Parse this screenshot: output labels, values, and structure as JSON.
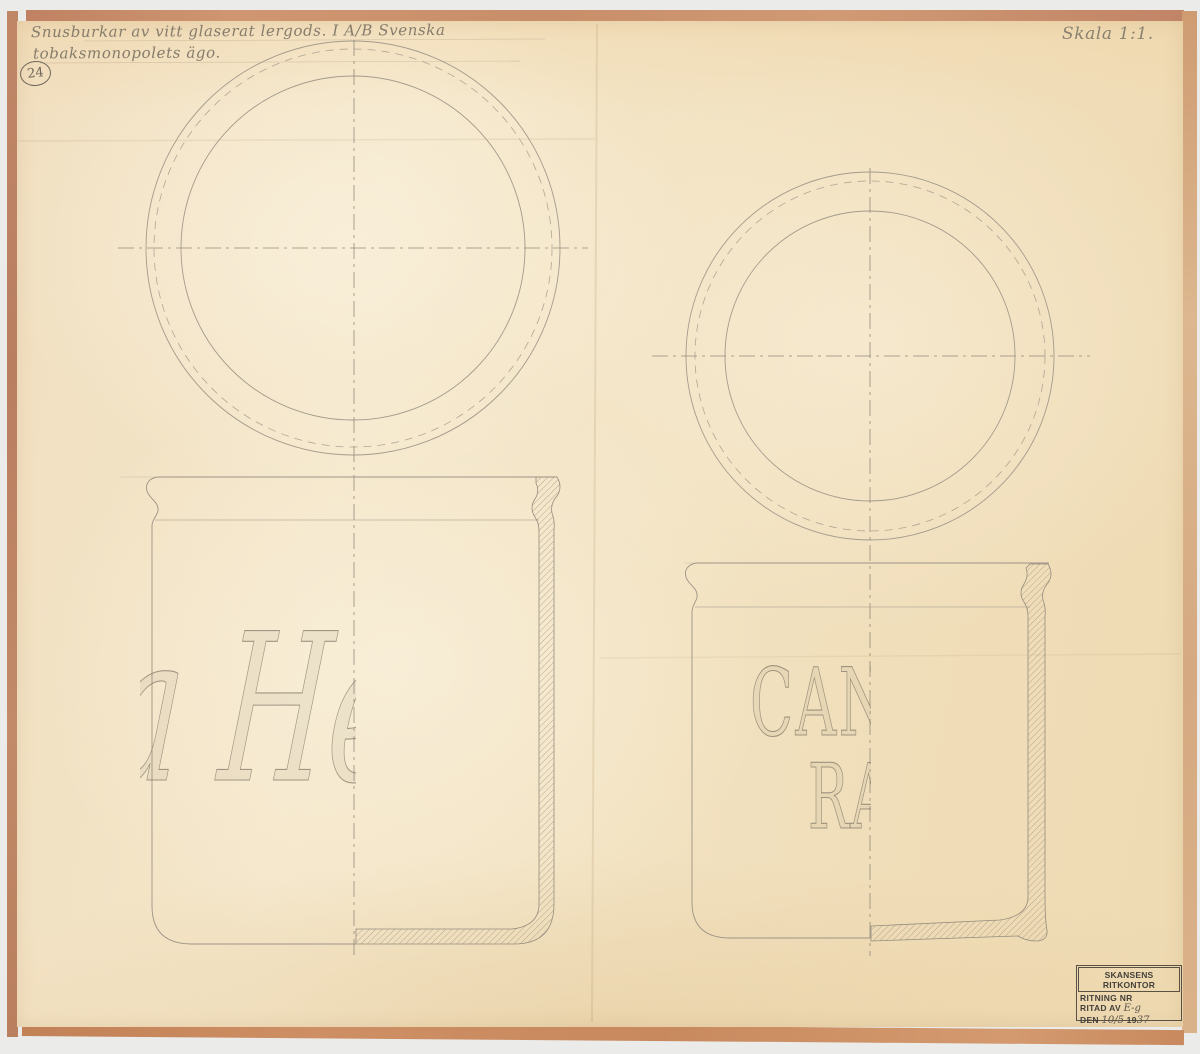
{
  "sheet": {
    "annotation_line1": "Snusburkar av vitt glaserat lergods. I A/B Svenska",
    "annotation_line2": "tobaksmonopolets ägo.",
    "sheet_number": "24",
    "scale_label": "Skala 1:1."
  },
  "left_jar": {
    "lettering_fragment": "a Hellg"
  },
  "right_jar": {
    "lettering_line1": "CANZ",
    "lettering_line2": "RA"
  },
  "title_block": {
    "office_stamp": "SKANSENS RITKONTOR",
    "drawing_no_label": "RITNING NR",
    "drawn_by_label": "RITAD AV",
    "drawn_by_value": "E-g",
    "date_label": "DEN",
    "date_day": "10/5",
    "date_year_prefix": "19",
    "date_year_suffix": "37"
  },
  "colors": {
    "paper": "#f3e4c4",
    "mount_frame": "#c78b66",
    "pencil": "#9a9183",
    "stamp_ink": "#44403a"
  }
}
